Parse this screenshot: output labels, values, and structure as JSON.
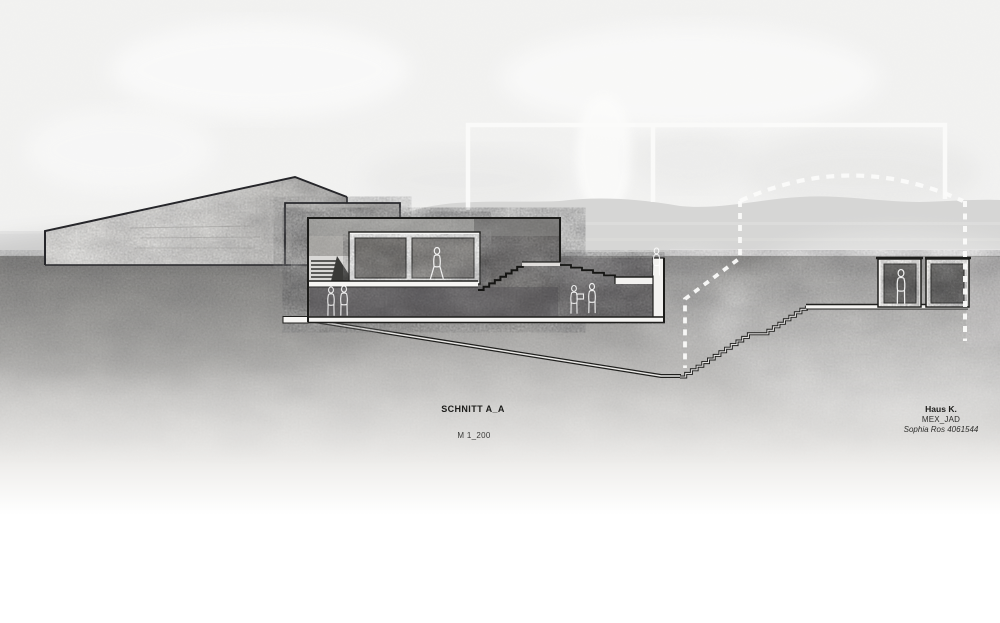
{
  "drawing": {
    "section_title": "SCHNITT A_A",
    "scale": "M 1_200",
    "project": "Haus K.",
    "code": "MEX_JAD",
    "author": "Sophia Ros 4061544"
  },
  "palette": {
    "paper": "#f1f1f0",
    "hills_band": "#d6d6d5",
    "ground_top": "#8a8988",
    "concrete_light": "#d7d6d4",
    "concrete_mid": "#b9b8b6",
    "earth_dark": "#6f6d6e",
    "ink": "#1f1f1d",
    "annotation_white": "#fafafa"
  },
  "figures": [
    "walking-person-interior",
    "person-lower-level-a",
    "person-lower-level-b",
    "person-terrace-with-box",
    "person-terrace-b",
    "person-at-building-edge",
    "person-in-pavilion"
  ]
}
